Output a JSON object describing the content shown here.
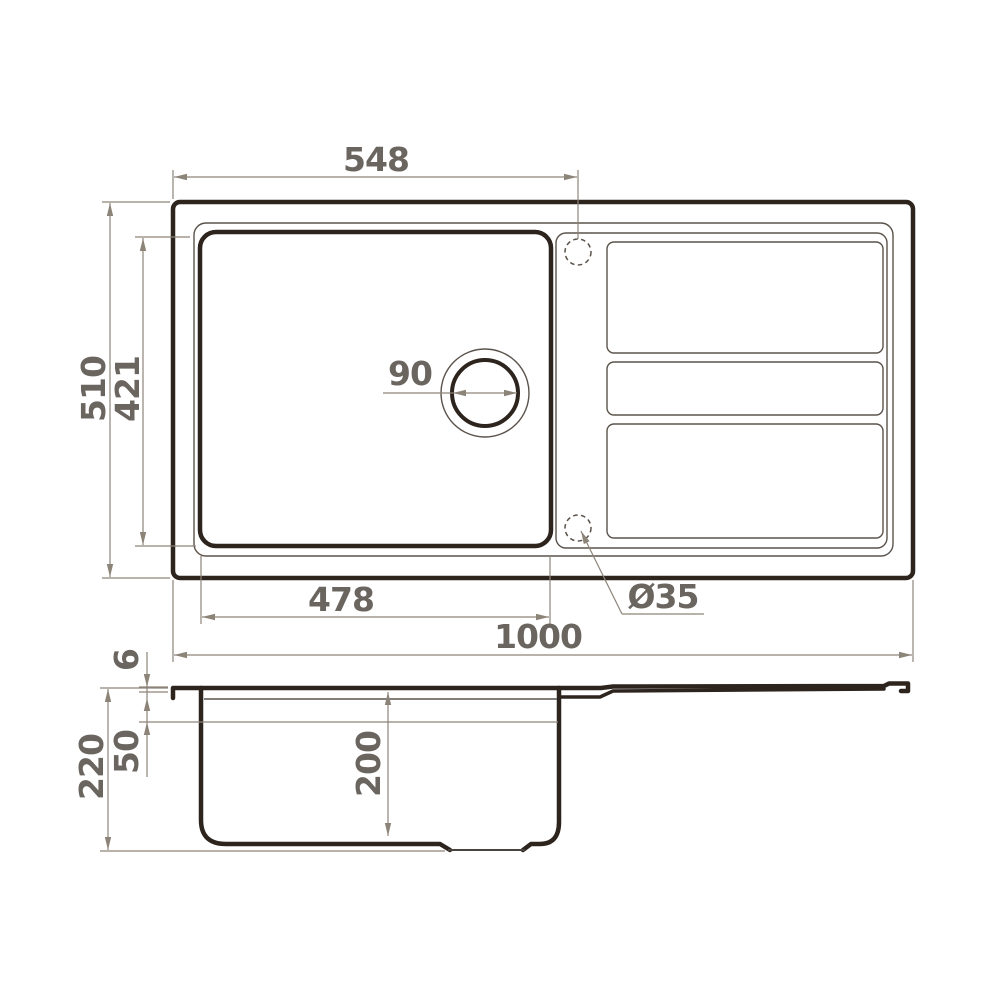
{
  "title": "Kitchen sink dimensional drawing (top view and section view)",
  "colors": {
    "line_dark": "#2d241e",
    "line_thin": "#5b534b",
    "dim_line": "#8d8479",
    "text_color": "#6b6560",
    "bg": "#ffffff"
  },
  "dims": {
    "d548": "548",
    "d510": "510",
    "d421": "421",
    "d90": "90",
    "d478": "478",
    "d1000": "1000",
    "dia35": "Ø35",
    "d6": "6",
    "d50": "50",
    "d220": "220",
    "d200": "200"
  }
}
